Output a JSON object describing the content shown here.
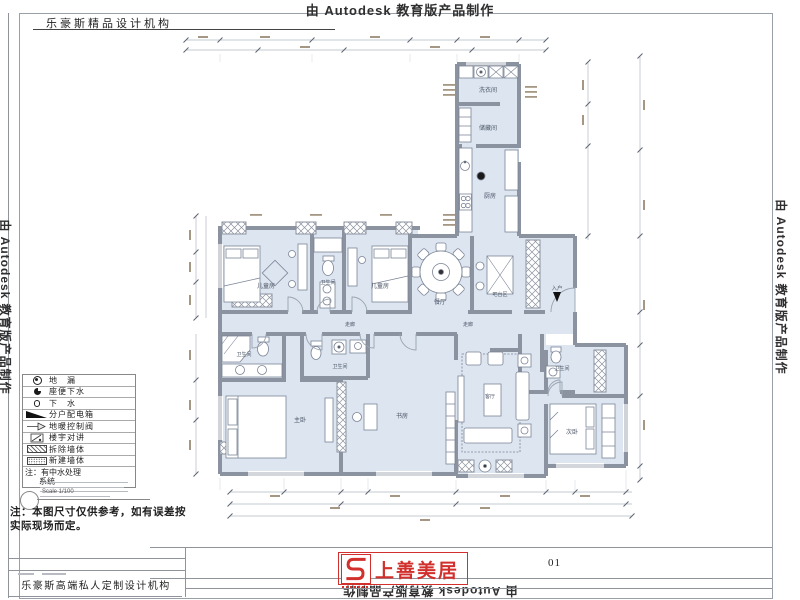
{
  "watermarks": {
    "top": "由 Autodesk 教育版产品制作",
    "left": "由 Autodesk 教育版产品制作",
    "right": "由 Autodesk 教育版产品制作",
    "bottom": "由 Autodesk 教育版产品制作"
  },
  "title_block": {
    "studio_top": "乐豪斯精品设计机构",
    "studio_bottom": "乐豪斯高端私人定制设计机构"
  },
  "sheet": {
    "page_number": "01",
    "scale_label": "Scale 1/100"
  },
  "disclaimer": {
    "line1": "注：本图尺寸仅供参考，如有误差按",
    "line2": "实际现场而定。"
  },
  "legend": {
    "rows": [
      {
        "icon": "floor-drain",
        "label": "地　漏"
      },
      {
        "icon": "toilet-drain",
        "label": "座便下水"
      },
      {
        "icon": "drain",
        "label": "下　水"
      },
      {
        "icon": "power-distribution-box",
        "label": "分户配电箱"
      },
      {
        "icon": "floor-heating-valve",
        "label": "地暖控制阀"
      },
      {
        "icon": "building-intercom",
        "label": "楼宇对讲"
      },
      {
        "icon": "demolished-wall",
        "label": "拆除墙体"
      },
      {
        "icon": "new-wall",
        "label": "新建墙体"
      }
    ],
    "note_line1": "注：有中水处理",
    "note_line2": "系统"
  },
  "logo": {
    "name": "上善美居"
  },
  "plan": {
    "rooms": [
      {
        "label": "儿童房"
      },
      {
        "label": "卫生间"
      },
      {
        "label": "儿童房"
      },
      {
        "label": "洗衣间"
      },
      {
        "label": "储藏间"
      },
      {
        "label": "厨房"
      },
      {
        "label": "餐厅"
      },
      {
        "label": "吧台区"
      },
      {
        "label": "走廊"
      },
      {
        "label": "走廊"
      },
      {
        "label": "卫生间"
      },
      {
        "label": "卫生间"
      },
      {
        "label": "主卧"
      },
      {
        "label": "书房"
      },
      {
        "label": "客厅"
      },
      {
        "label": "次卧"
      },
      {
        "label": "卫生间"
      },
      {
        "label": "入户"
      }
    ]
  }
}
